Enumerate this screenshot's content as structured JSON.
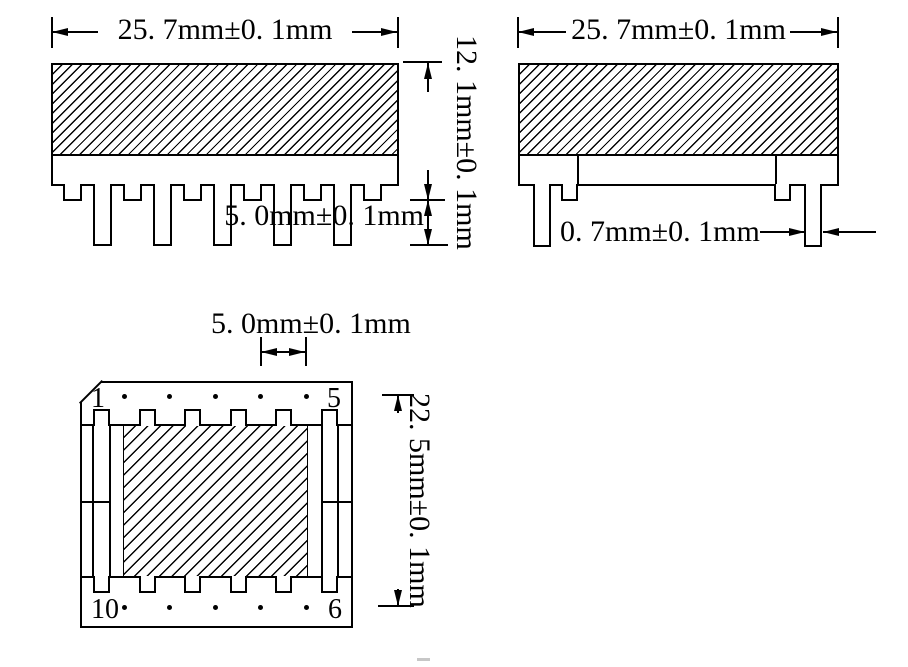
{
  "canvas": {
    "background": "#ffffff",
    "line_color": "#000000"
  },
  "views": {
    "front": {
      "width_dim": "25. 7mm±0. 1mm",
      "height_dim": "12. 1mm±0. 1mm",
      "pin_length_dim": "5. 0mm±0. 1mm",
      "long_pin_count": 5,
      "stub_count": 6
    },
    "side": {
      "width_dim": "25. 7mm±0. 1mm",
      "pin_thickness_dim": "0. 7mm±0. 1mm",
      "long_pin_count": 2,
      "stub_count": 2
    },
    "top": {
      "pin_pitch_dim": "5. 0mm±0. 1mm",
      "depth_dim": "22. 5mm±0. 1mm",
      "pin_numbers": {
        "top_left": "1",
        "top_right": "5",
        "bottom_left": "10",
        "bottom_right": "6"
      },
      "dots_per_row": 5,
      "tabs_per_row": 6
    }
  }
}
